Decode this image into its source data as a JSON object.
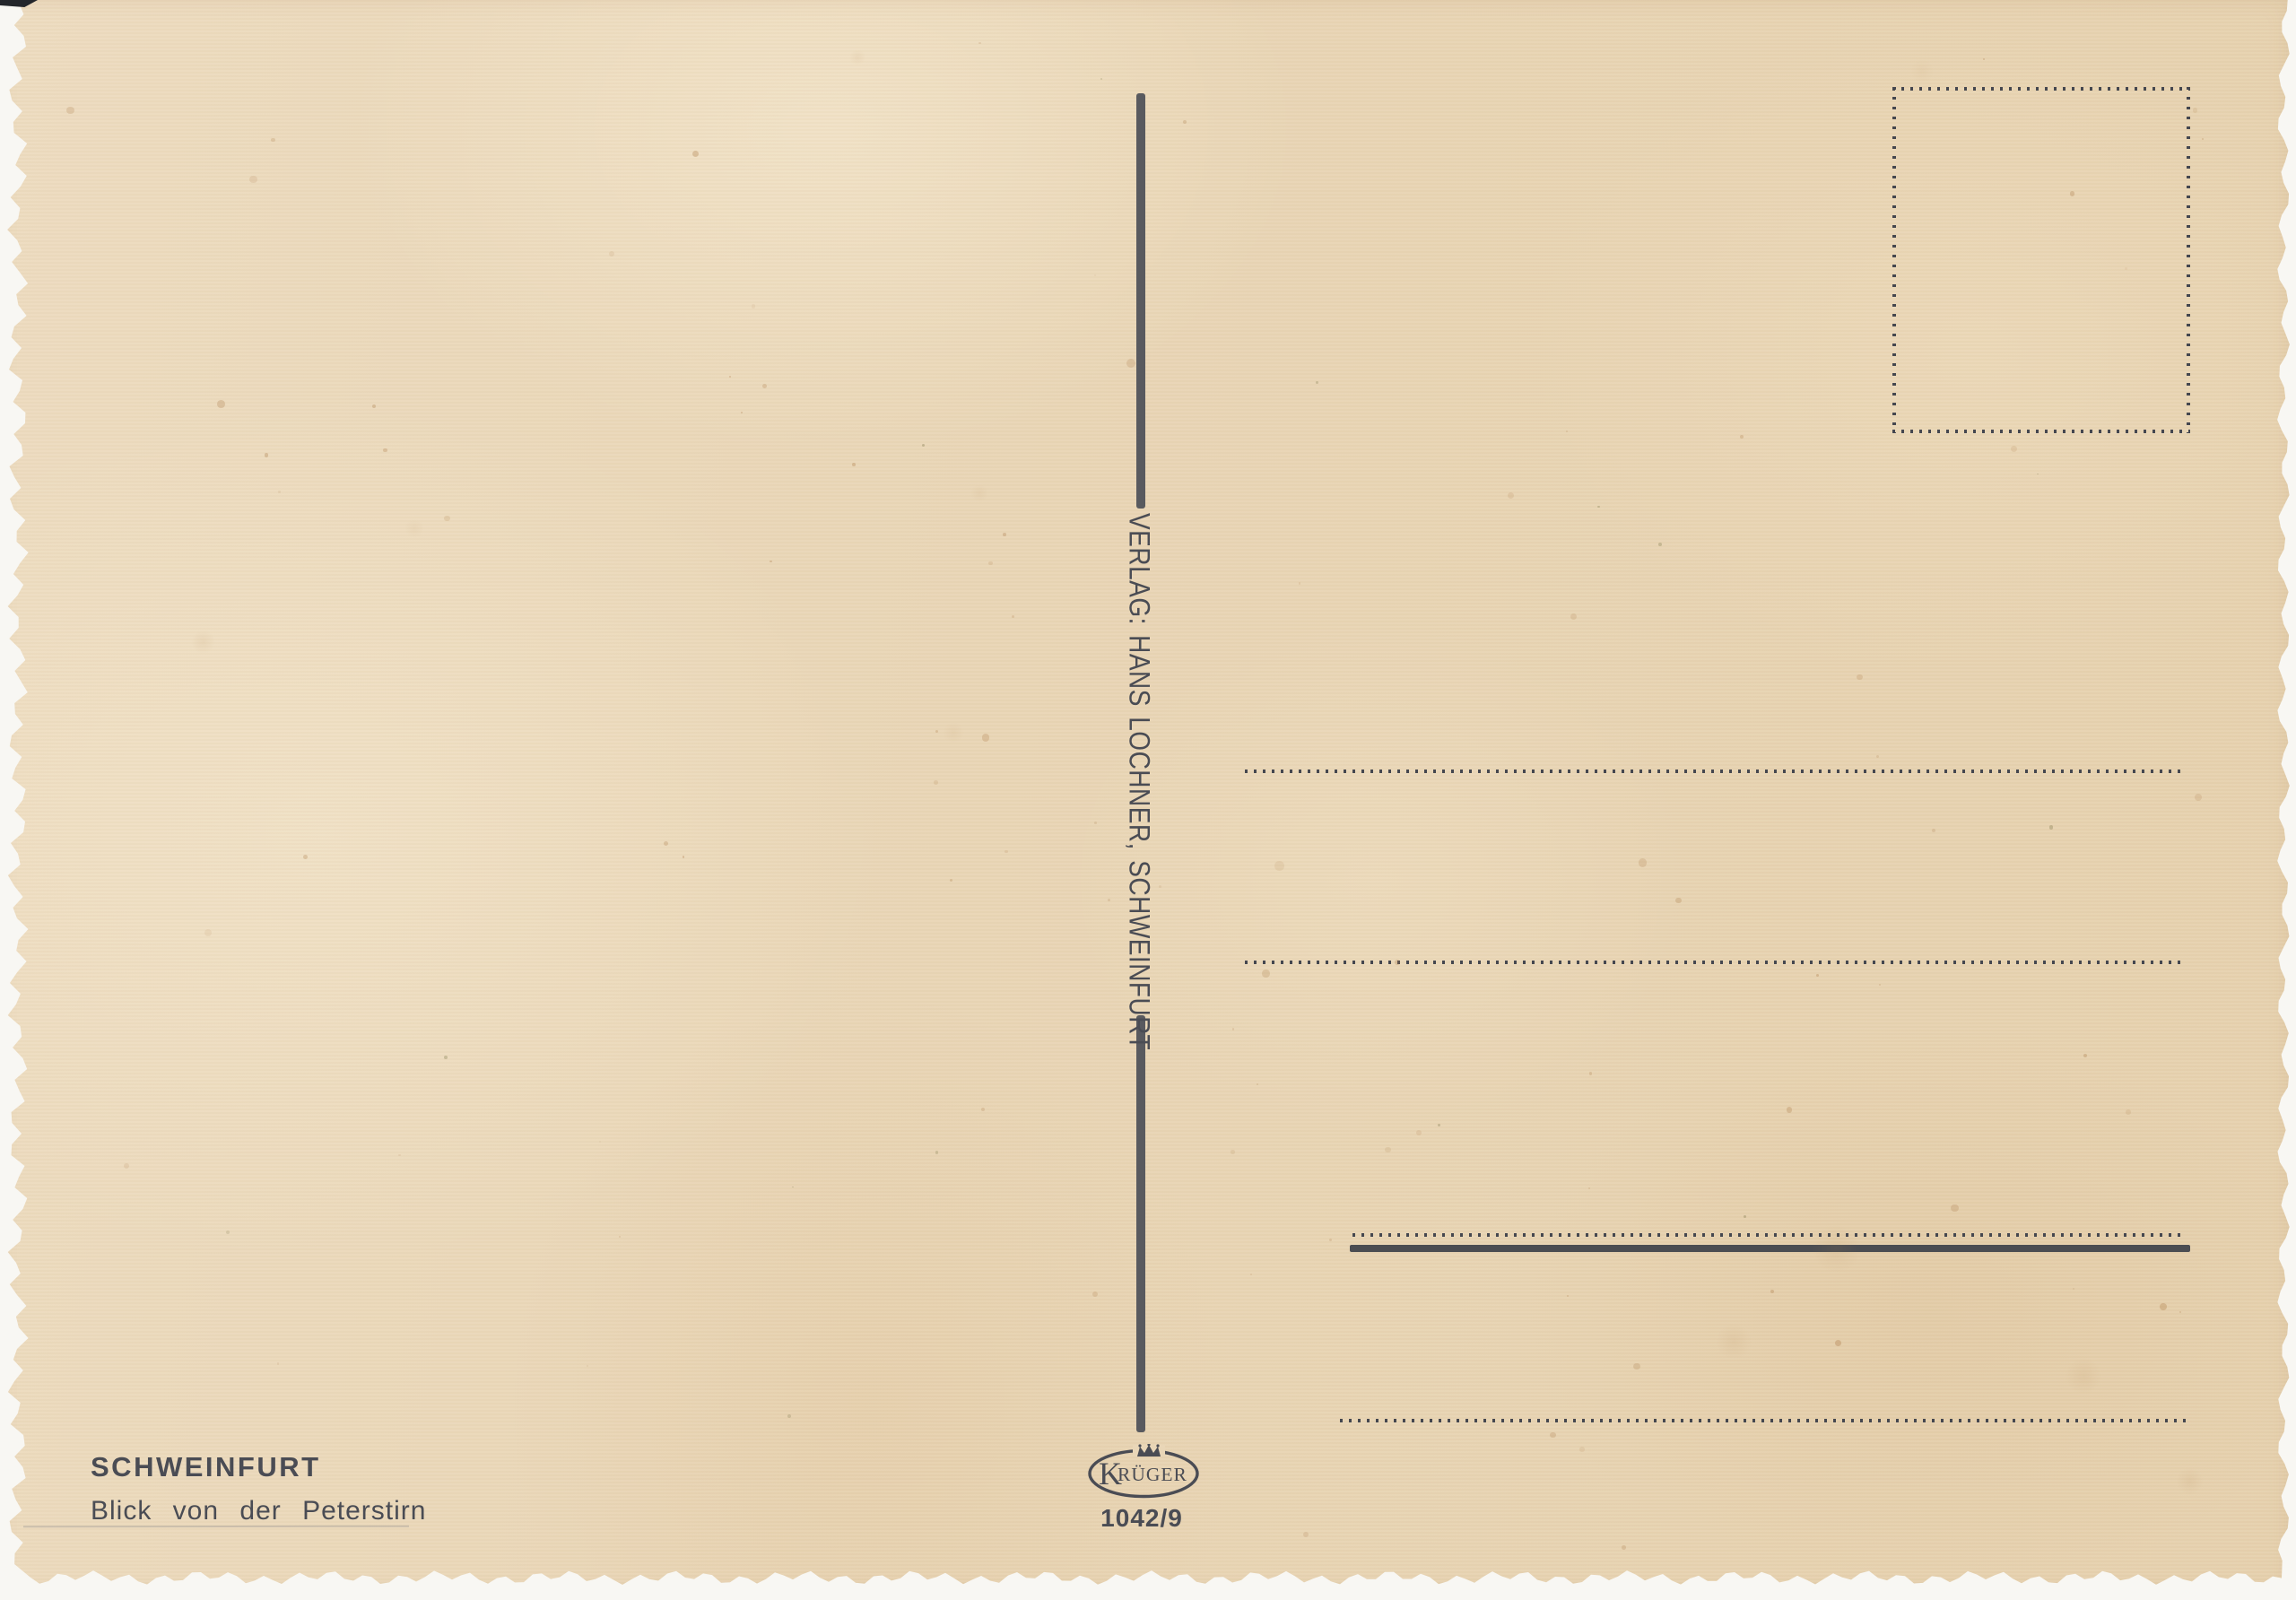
{
  "postcard": {
    "title": "SCHWEINFURT",
    "caption": "Blick von der Peterstirn",
    "publisher": "VERLAG: HANS LOCHNER, SCHWEINFURT",
    "logo": {
      "brand_initial": "K",
      "brand_rest": "RÜGER"
    },
    "order_number": "1042/9"
  },
  "colors": {
    "ink": "#4a4c54",
    "paper_base": "#e9d6b7",
    "scan_background": "#f8f7f3"
  }
}
